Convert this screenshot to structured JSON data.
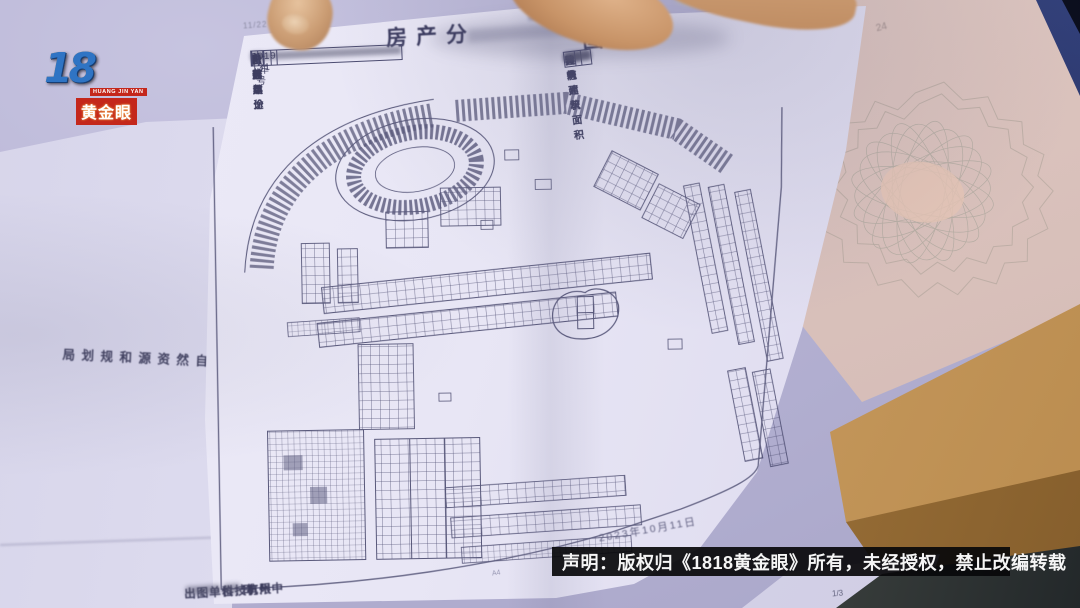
{
  "colors": {
    "background_lavender": "#b6b3d4",
    "paper_white": "#eceaf7",
    "certificate_pink": "#dcc4be",
    "kraft_tan": "#c79a5e",
    "cover_navy": "#1a2148",
    "logo_red": "#c4271b",
    "logo_gold": "#e59a34",
    "logo_blue": "#2f74c4",
    "watermark_bg": "#0a0a0c",
    "ink": "#45456a"
  },
  "logo": {
    "number": "1818",
    "romanized": "HUANG JIN YAN",
    "name": "黄金眼"
  },
  "copyright_bar": {
    "text": "声明：版权归《1818黄金眼》所有，未经授权，禁止改编转载"
  },
  "document": {
    "print_timestamp": "11/22 16:",
    "title": {
      "left": "房产分",
      "right": "图"
    },
    "left_table": {
      "rows": [
        {
          "label": "坐  落",
          "value": ""
        },
        {
          "label": "设计用途",
          "value": "商业",
          "label2": "总层数",
          "value2": ""
        },
        {
          "label": "建成年份",
          "value": "2019年",
          "label2": "所在层",
          "value2": "4"
        },
        {
          "label": "户  号",
          "value": "1-131号"
        }
      ]
    },
    "right_table": {
      "rows": [
        {
          "label": "幢  号",
          "value": ""
        },
        {
          "label": "套内建筑面积",
          "value": ""
        },
        {
          "label": "共有建筑面积",
          "value": ""
        },
        {
          "label": "建 筑 面 积",
          "value": ""
        }
      ]
    },
    "drawing_date": "2023年10月11日",
    "paper_note": "A4",
    "footer": {
      "prefix": "出图单位：杭州中",
      "mid": "科技有限",
      "suffix": "司"
    },
    "page_number": "1/3"
  },
  "under_page": {
    "vertical_text": "县自然资源和规划局"
  },
  "pencil_note": "24"
}
